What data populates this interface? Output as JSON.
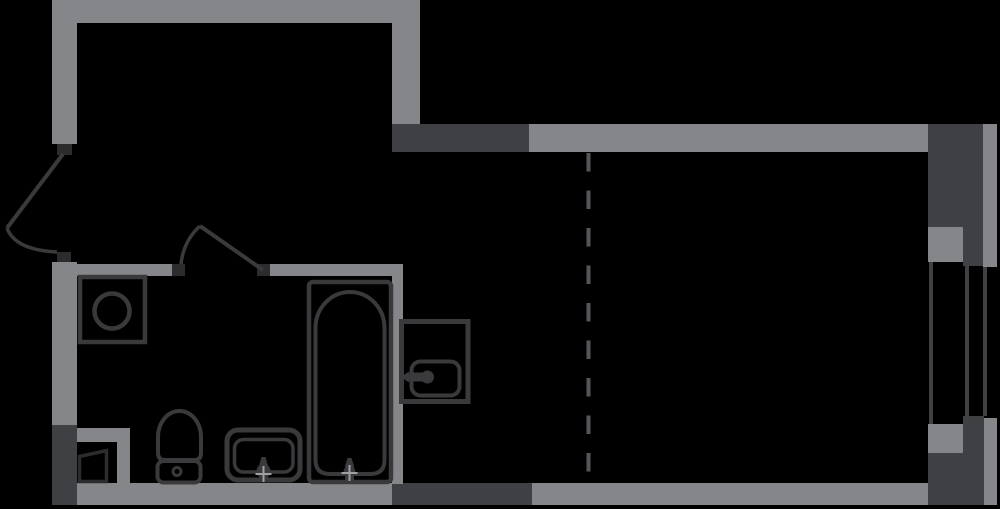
{
  "plan": {
    "kind": "apartment-floor-plan",
    "canvas": {
      "width": 1000,
      "height": 509
    },
    "rooms": [
      {
        "id": "entrance-hall",
        "position": "top-left"
      },
      {
        "id": "bathroom",
        "position": "bottom-left"
      },
      {
        "id": "main-room",
        "position": "right"
      }
    ],
    "fixtures": [
      {
        "icon": "washing-machine-icon",
        "room": "bathroom"
      },
      {
        "icon": "toilet-icon",
        "room": "bathroom"
      },
      {
        "icon": "sink-icon",
        "room": "bathroom"
      },
      {
        "icon": "bathtub-icon",
        "room": "bathroom"
      },
      {
        "icon": "utility-shaft-icon",
        "room": "bathroom"
      },
      {
        "icon": "kitchen-sink-icon",
        "room": "main-room"
      },
      {
        "icon": "door-swing-icon",
        "room": "entrance-hall"
      },
      {
        "icon": "door-swing-icon",
        "room": "bathroom"
      },
      {
        "icon": "window-icon",
        "room": "main-room"
      },
      {
        "icon": "zone-divider-dashed-line",
        "room": "main-room"
      }
    ]
  },
  "colors": {
    "background": "#000000",
    "wall": "#85868a",
    "wall_dark": "#3f4043",
    "hinge": "#2c2c2e",
    "fixture": "#3a3a3d",
    "door": "#3a3a3d",
    "glass": "#3f4043",
    "dash": "#55565a",
    "cross": "#9fa0a4"
  },
  "dash_pattern": "18.5 19"
}
